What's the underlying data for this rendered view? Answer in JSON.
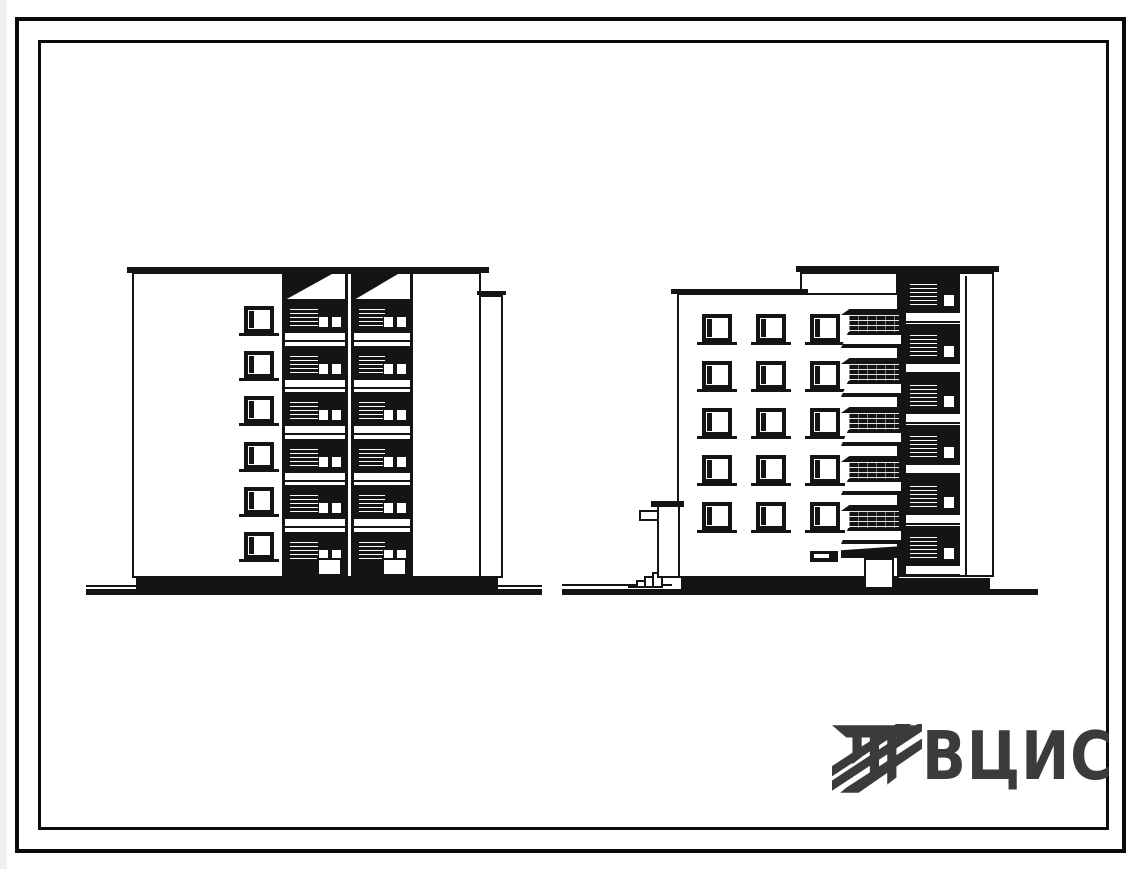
{
  "page": {
    "background": "#ffffff",
    "ink": "#141414",
    "scan_edge_color": "#f1f1f0"
  },
  "logo": {
    "text": "ВЦИС",
    "color": "#3b3b3e",
    "emblem": "striped-column-mark"
  },
  "drawings": {
    "left_elevation": {
      "id": "left-building-elevation",
      "type": "end elevation with loggias",
      "loggia_bays": 2,
      "loggia_levels": 6,
      "window_rows": 6,
      "window_cols": 1
    },
    "right_elevation": {
      "id": "right-building-elevation",
      "type": "side elevation with balconies and stair porch",
      "window_rows": 5,
      "window_cols": 3,
      "balcony_levels": 5,
      "side_loggia_levels": 6
    }
  }
}
